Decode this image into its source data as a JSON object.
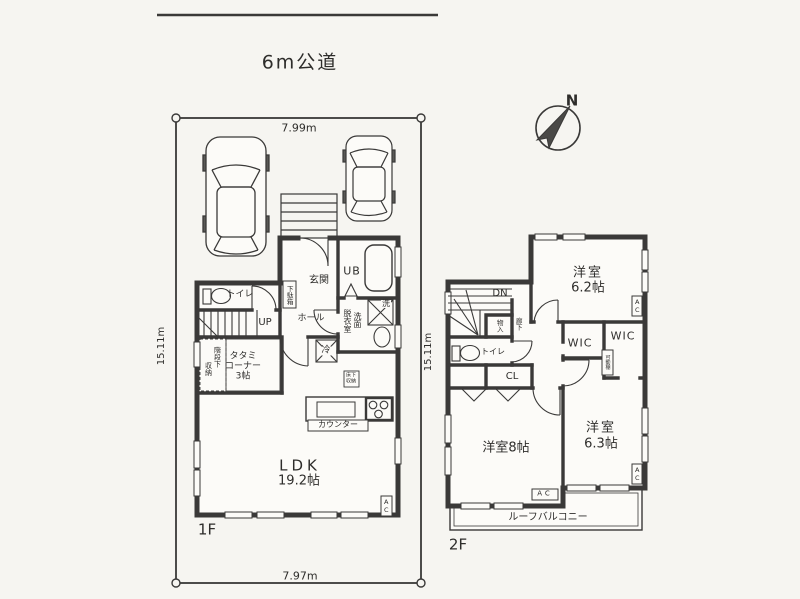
{
  "colors": {
    "ink": "#3a3938",
    "paper": "#f6f5f1",
    "floor": "#fcfbf8"
  },
  "site": {
    "road_label": "6m公道",
    "north_label": "N",
    "dim_top": "7.99m",
    "dim_bottom": "7.97m",
    "dim_left": "15.11m"
  },
  "floor1": {
    "label": "1F",
    "rooms": {
      "ldk_name": "LDK",
      "ldk_size": "19.2帖",
      "genkan": "玄関",
      "hall": "ホール",
      "toilet": "トイレ",
      "unit_bath": "UB",
      "washroom_col_right": "洗面",
      "washroom_col_left": "脱衣室",
      "tatami_line1": "タタミ",
      "tatami_line2": "コーナー",
      "tatami_line3": "3帖"
    },
    "fixtures": {
      "shoe_cabinet": "下駄箱",
      "stairs_up": "UP",
      "under_stair_col_right": "階段下",
      "under_stair_col_left": "収納",
      "floor_storage_line1": "床下",
      "floor_storage_line2": "収納",
      "counter": "カウンター",
      "washer": "洗",
      "fridge": "冷",
      "ac": "AC"
    }
  },
  "floor2": {
    "label": "2F",
    "dim_left": "15.11m",
    "rooms": {
      "bedroom62_name": "洋室",
      "bedroom62_size": "6.2帖",
      "bedroom8": "洋室8帖",
      "bedroom63_name": "洋室",
      "bedroom63_size": "6.3帖",
      "toilet": "トイレ",
      "wic1": "WIC",
      "wic2": "WIC",
      "closet": "CL",
      "corridor": "廊下",
      "balcony": "ルーフバルコニー"
    },
    "fixtures": {
      "stairs_dn": "DN",
      "storage": "物入",
      "movable_shelf": "可動棚",
      "ac_right_top": "AC",
      "ac_right_bottom": "AC",
      "ac_bottom": "AC"
    }
  }
}
